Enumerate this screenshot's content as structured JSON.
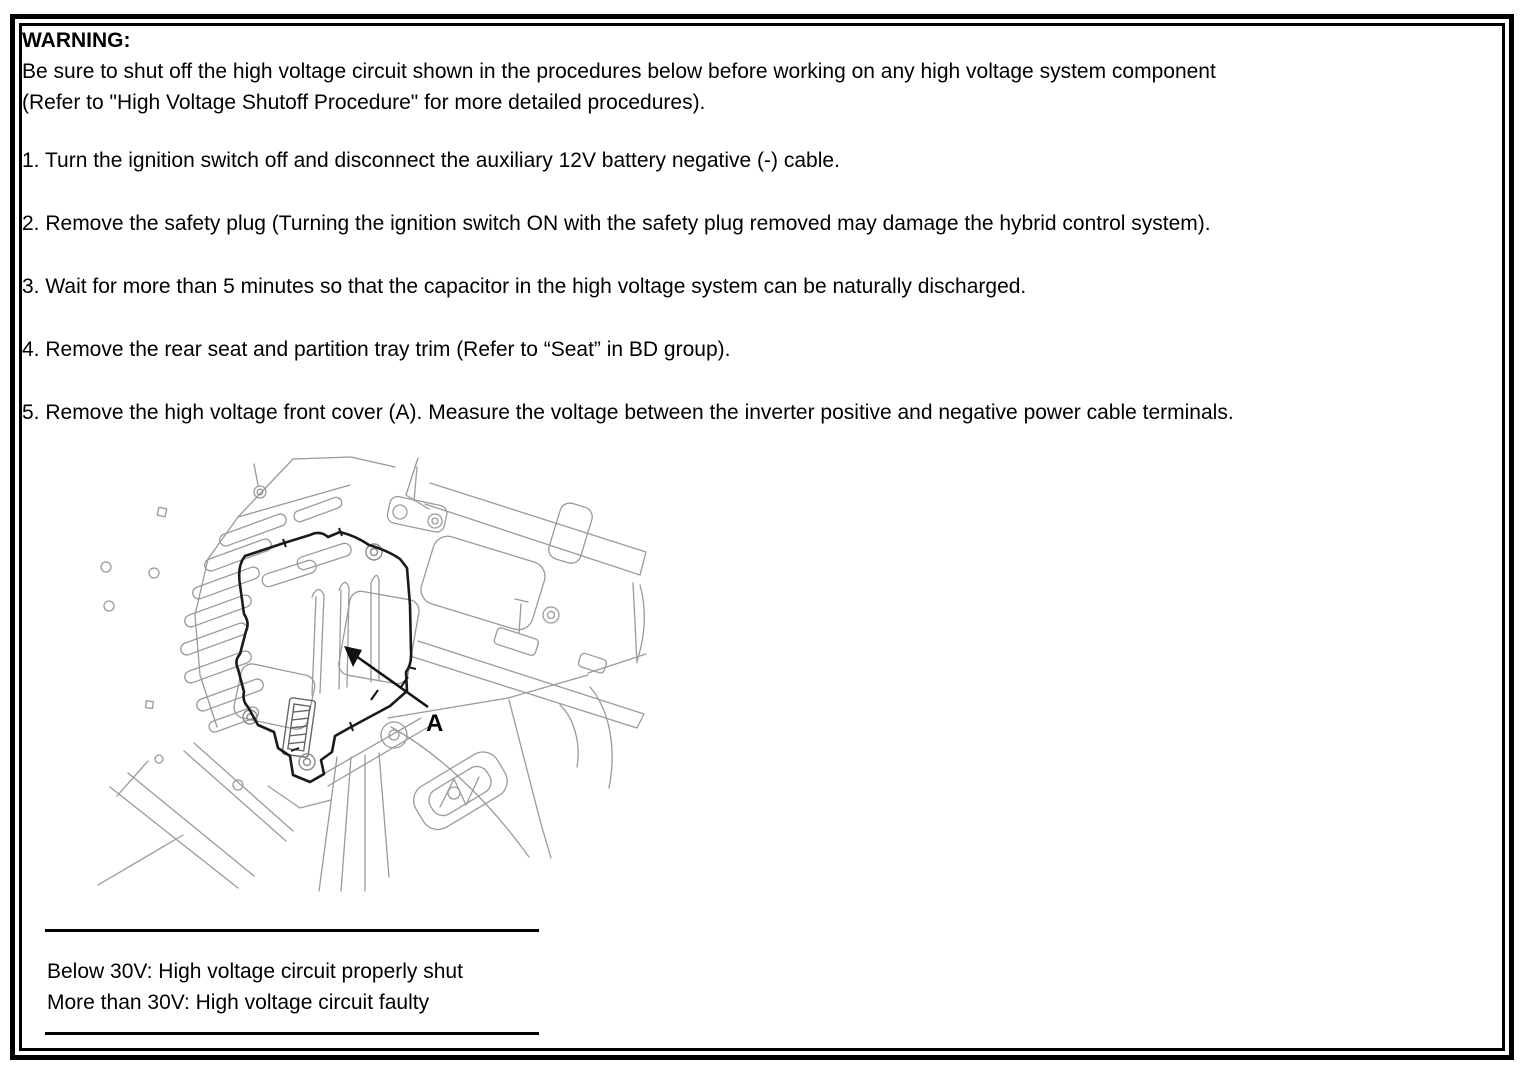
{
  "document": {
    "warning_title": "WARNING:",
    "warning_line1": "Be sure to shut off the high voltage circuit shown in the procedures below before working on any high voltage system component",
    "warning_line2": "(Refer to \"High Voltage Shutoff Procedure\" for more detailed procedures).",
    "steps": [
      "1. Turn the ignition switch off and disconnect the auxiliary 12V battery negative (-) cable.",
      "2. Remove the safety plug (Turning the ignition switch ON with the safety plug removed may damage the hybrid control system).",
      "3. Wait for more than 5 minutes so that the capacitor in the high voltage system can be naturally discharged.",
      "4. Remove the rear seat and partition tray trim (Refer to “Seat” in BD group).",
      "5. Remove the high voltage front cover (A). Measure the voltage between the inverter positive and negative power cable terminals."
    ],
    "figure": {
      "callout": "A"
    },
    "note": {
      "line1": "Below 30V: High voltage circuit properly shut",
      "line2": "More than 30V: High voltage circuit faulty"
    },
    "colors": {
      "line_art_gray": "#9a9a9a",
      "cover_outline_black": "#1a1a1a"
    }
  }
}
